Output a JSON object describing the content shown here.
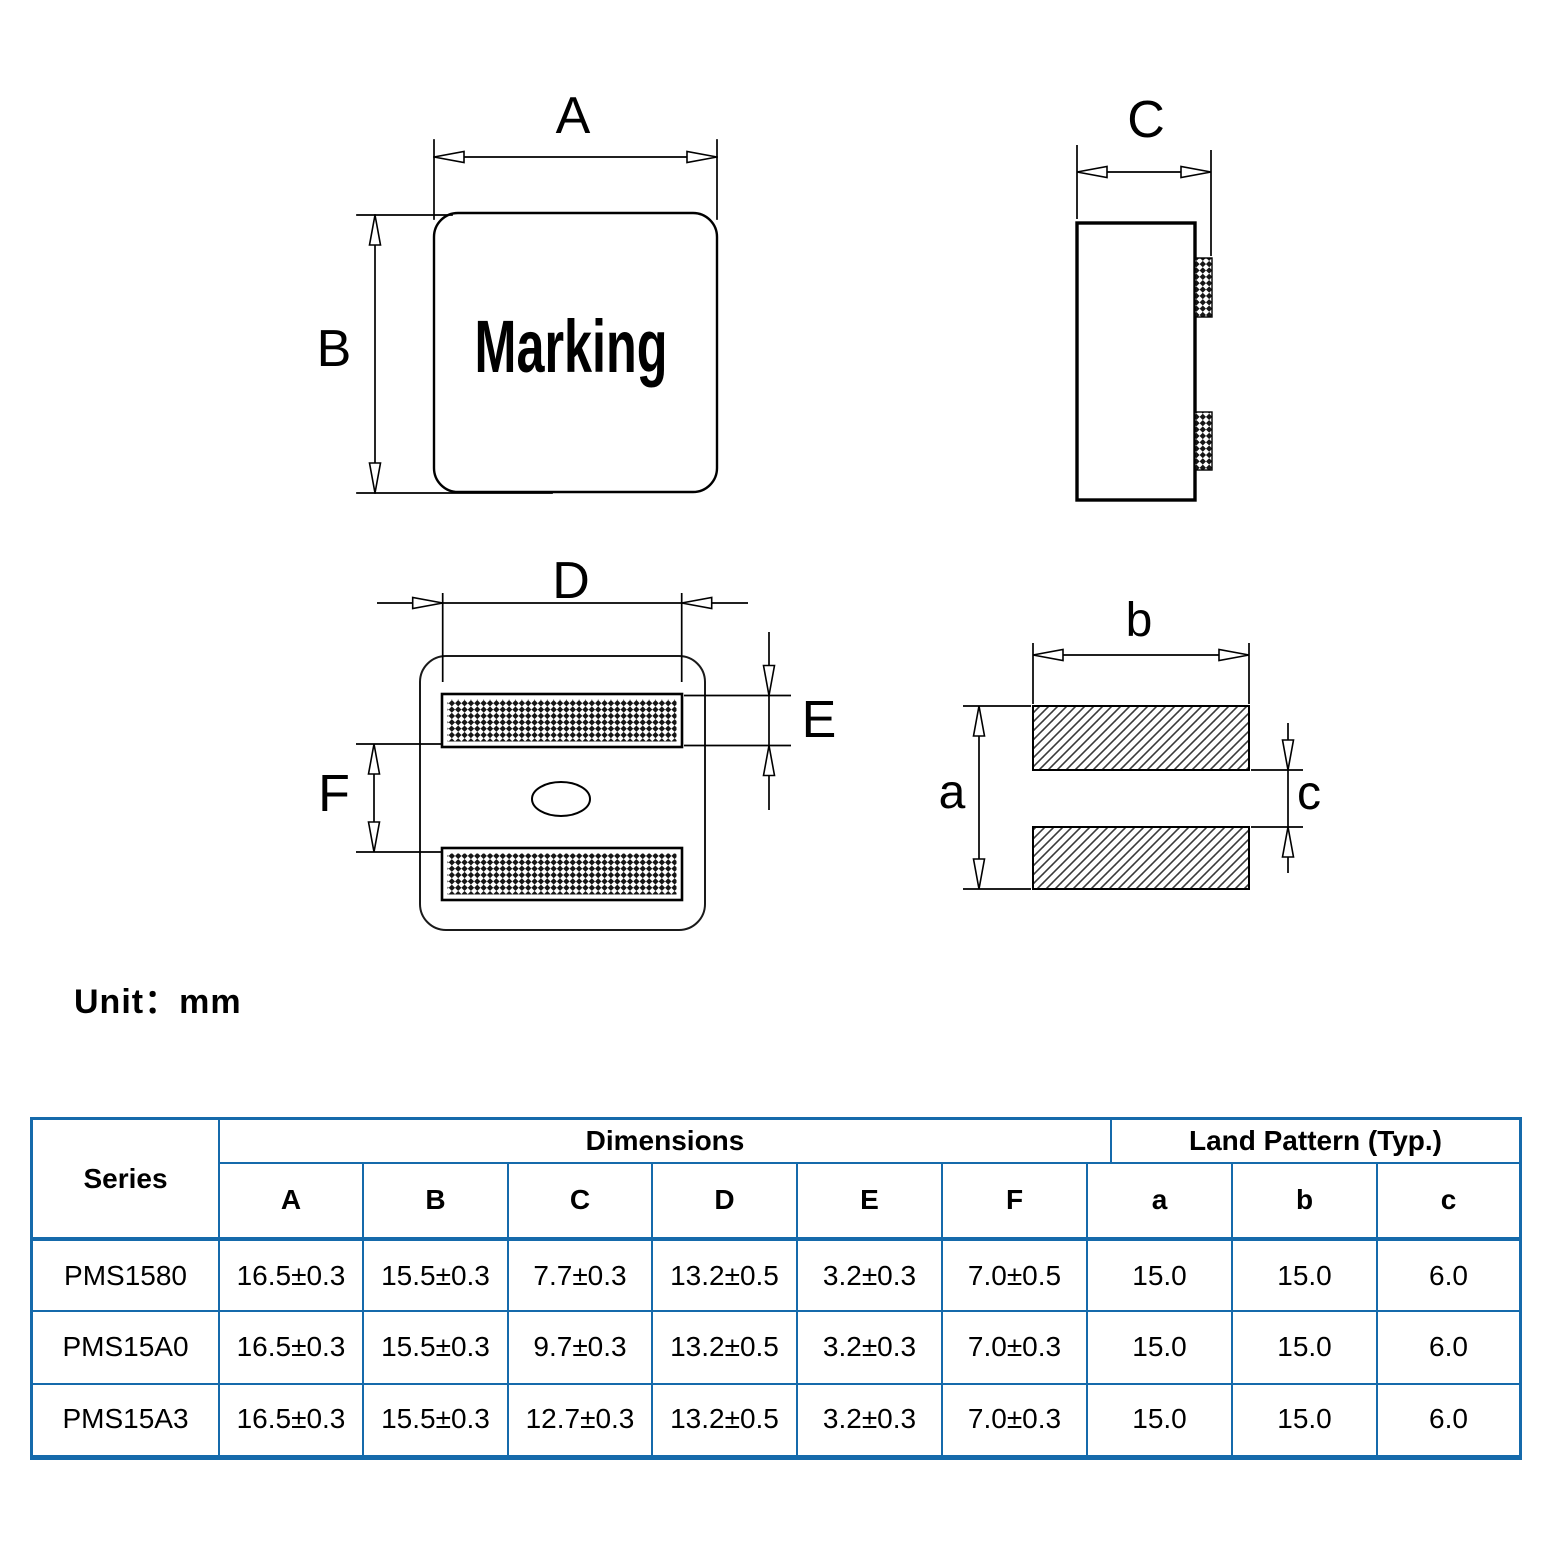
{
  "unit_label": "Unit：mm",
  "diagram": {
    "marking": "Marking",
    "dim_A": "A",
    "dim_B": "B",
    "dim_C": "C",
    "dim_D": "D",
    "dim_E": "E",
    "dim_F": "F",
    "land_a": "a",
    "land_b": "b",
    "land_c": "c"
  },
  "colors": {
    "table_border": "#156aab",
    "line_color": "#000000"
  },
  "table": {
    "headers": {
      "series": "Series",
      "dimensions": "Dimensions",
      "land_pattern": "Land Pattern (Typ.)",
      "columns": [
        "A",
        "B",
        "C",
        "D",
        "E",
        "F",
        "a",
        "b",
        "c"
      ]
    },
    "rows": [
      {
        "series": "PMS1580",
        "values": [
          "16.5±0.3",
          "15.5±0.3",
          "7.7±0.3",
          "13.2±0.5",
          "3.2±0.3",
          "7.0±0.5",
          "15.0",
          "15.0",
          "6.0"
        ]
      },
      {
        "series": "PMS15A0",
        "values": [
          "16.5±0.3",
          "15.5±0.3",
          "9.7±0.3",
          "13.2±0.5",
          "3.2±0.3",
          "7.0±0.3",
          "15.0",
          "15.0",
          "6.0"
        ]
      },
      {
        "series": "PMS15A3",
        "values": [
          "16.5±0.3",
          "15.5±0.3",
          "12.7±0.3",
          "13.2±0.5",
          "3.2±0.3",
          "7.0±0.3",
          "15.0",
          "15.0",
          "6.0"
        ]
      }
    ]
  }
}
